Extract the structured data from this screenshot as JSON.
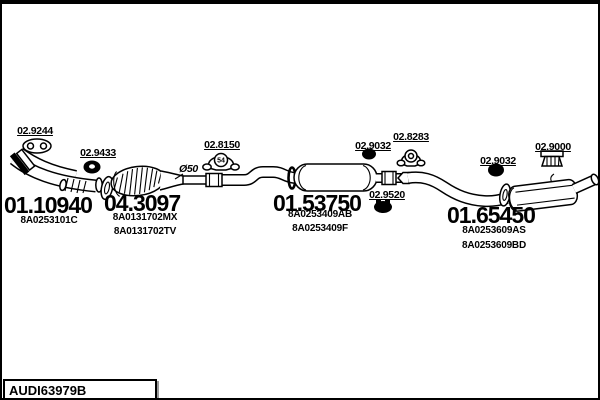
{
  "drawing": {
    "footer_code": "AUDI63979B"
  },
  "annotations": {
    "pipe_diameter": "Ø50"
  },
  "parts": {
    "gasket_9244": {
      "code": "02.9244"
    },
    "gasket_9433": {
      "code": "02.9433"
    },
    "clamp_8150": {
      "code": "02.8150",
      "size": "54"
    },
    "hanger_9032_mid": {
      "code": "02.9032"
    },
    "clamp_8283": {
      "code": "02.8283"
    },
    "hanger_9520": {
      "code": "02.9520"
    },
    "hanger_9032_rear": {
      "code": "02.9032"
    },
    "mount_9000": {
      "code": "02.9000"
    },
    "front_pipe": {
      "code": "01.10940",
      "oem": [
        "8A0253101C"
      ]
    },
    "catalyst": {
      "code": "04.3097",
      "oem": [
        "8A0131702MX",
        "8A0131702TV"
      ]
    },
    "centre_muffler": {
      "code": "01.53750",
      "oem": [
        "8A0253409AB",
        "8A0253409F"
      ]
    },
    "rear_muffler": {
      "code": "01.65450",
      "oem": [
        "8A0253609AS",
        "8A0253609BD"
      ]
    }
  }
}
